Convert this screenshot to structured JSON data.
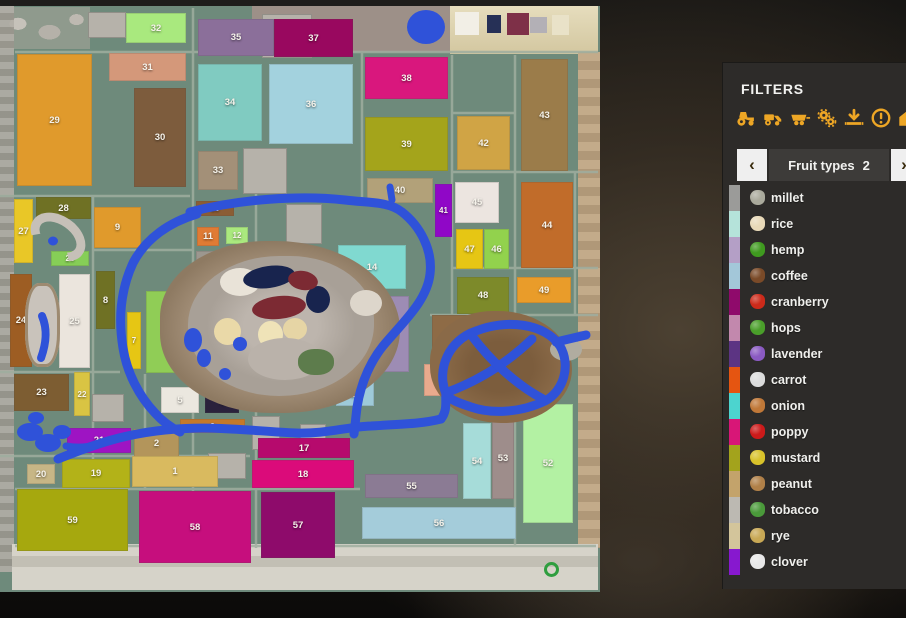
{
  "colors": {
    "accent": "#eda625",
    "water": "#2f52d9",
    "panel_bg": "#2d2b29",
    "marker_green": "#2f9e3f",
    "map_grass": "#6e8a7b"
  },
  "filters_panel": {
    "title": "FILTERS",
    "icons": [
      {
        "name": "tractor-icon"
      },
      {
        "name": "harvester-icon"
      },
      {
        "name": "trailer-icon"
      },
      {
        "name": "gears-icon"
      },
      {
        "name": "unload-arrow-icon"
      },
      {
        "name": "warning-icon"
      },
      {
        "name": "house-icon"
      }
    ],
    "selector": {
      "prev": "‹",
      "label": "Fruit types",
      "count": "2",
      "next": "›"
    },
    "fruits": [
      {
        "label": "millet",
        "bar_color": "#9b9b99",
        "icon_color": "#aaaa9c"
      },
      {
        "label": "rice",
        "bar_color": "#b5e3da",
        "icon_color": "#e8d9b8"
      },
      {
        "label": "hemp",
        "bar_color": "#b49fc6",
        "icon_color": "#3f9a1f"
      },
      {
        "label": "coffee",
        "bar_color": "#a3c7d9",
        "icon_color": "#7a4a28"
      },
      {
        "label": "cranberry",
        "bar_color": "#8f0a6b",
        "icon_color": "#cc2a1a"
      },
      {
        "label": "hops",
        "bar_color": "#c288ad",
        "icon_color": "#4a9e2a"
      },
      {
        "label": "lavender",
        "bar_color": "#5c3483",
        "icon_color": "#8a5ac2"
      },
      {
        "label": "carrot",
        "bar_color": "#e55511",
        "icon_color": "#dcdcdc"
      },
      {
        "label": "onion",
        "bar_color": "#4cd4cf",
        "icon_color": "#c07838"
      },
      {
        "label": "poppy",
        "bar_color": "#d81677",
        "icon_color": "#cc1a1a"
      },
      {
        "label": "mustard",
        "bar_color": "#a3a31c",
        "icon_color": "#d8c22a"
      },
      {
        "label": "peanut",
        "bar_color": "#c3a36b",
        "icon_color": "#b08048"
      },
      {
        "label": "tobacco",
        "bar_color": "#bcb9b2",
        "icon_color": "#4a9a3a"
      },
      {
        "label": "rye",
        "bar_color": "#d3c59b",
        "icon_color": "#c8a855"
      },
      {
        "label": "clover",
        "bar_color": "#8718cf",
        "icon_color": "#e8e8e8"
      }
    ]
  },
  "map": {
    "fields": [
      {
        "id": "29",
        "x": 17,
        "y": 54,
        "w": 75,
        "h": 132,
        "color": "#e09a2c"
      },
      {
        "id": "31",
        "x": 109,
        "y": 53,
        "w": 77,
        "h": 28,
        "color": "#d4987a"
      },
      {
        "id": "30",
        "x": 134,
        "y": 88,
        "w": 52,
        "h": 99,
        "color": "#7d5c3d"
      },
      {
        "id": "32",
        "x": 126,
        "y": 13,
        "w": 60,
        "h": 30,
        "color": "#a9e97e"
      },
      {
        "id": "35",
        "x": 198,
        "y": 19,
        "w": 76,
        "h": 37,
        "color": "#8b6f9a"
      },
      {
        "id": "37",
        "x": 274,
        "y": 19,
        "w": 79,
        "h": 38,
        "color": "#99085f"
      },
      {
        "id": "34",
        "x": 198,
        "y": 64,
        "w": 64,
        "h": 77,
        "color": "#80cbc1"
      },
      {
        "id": "36",
        "x": 269,
        "y": 64,
        "w": 84,
        "h": 80,
        "color": "#a3d2de"
      },
      {
        "id": "33",
        "x": 198,
        "y": 151,
        "w": 40,
        "h": 39,
        "color": "#a39078"
      },
      {
        "id": "38",
        "x": 365,
        "y": 57,
        "w": 83,
        "h": 42,
        "color": "#d9177d"
      },
      {
        "id": "39",
        "x": 365,
        "y": 117,
        "w": 83,
        "h": 54,
        "color": "#a4a41b"
      },
      {
        "id": "42",
        "x": 457,
        "y": 116,
        "w": 53,
        "h": 54,
        "color": "#d0a445"
      },
      {
        "id": "43",
        "x": 521,
        "y": 59,
        "w": 47,
        "h": 112,
        "color": "#9b7c4a"
      },
      {
        "id": "40",
        "x": 367,
        "y": 178,
        "w": 66,
        "h": 25,
        "color": "#b2a179"
      },
      {
        "id": "41",
        "x": 435,
        "y": 184,
        "w": 17,
        "h": 53,
        "color": "#9007c7"
      },
      {
        "id": "45",
        "x": 455,
        "y": 182,
        "w": 44,
        "h": 41,
        "color": "#ece5e0"
      },
      {
        "id": "44",
        "x": 521,
        "y": 182,
        "w": 52,
        "h": 86,
        "color": "#c16c2a"
      },
      {
        "id": "47",
        "x": 456,
        "y": 229,
        "w": 27,
        "h": 40,
        "color": "#e6c614"
      },
      {
        "id": "46",
        "x": 484,
        "y": 229,
        "w": 25,
        "h": 40,
        "color": "#92d24d"
      },
      {
        "id": "48",
        "x": 457,
        "y": 277,
        "w": 52,
        "h": 37,
        "color": "#7d8a2a"
      },
      {
        "id": "49",
        "x": 517,
        "y": 277,
        "w": 54,
        "h": 26,
        "color": "#e99c2a"
      },
      {
        "id": "27",
        "x": 14,
        "y": 199,
        "w": 19,
        "h": 64,
        "color": "#e9c727"
      },
      {
        "id": "28",
        "x": 36,
        "y": 197,
        "w": 55,
        "h": 22,
        "color": "#6f7124"
      },
      {
        "id": "9",
        "x": 94,
        "y": 207,
        "w": 47,
        "h": 41,
        "color": "#e09a2c"
      },
      {
        "id": "26",
        "x": 51,
        "y": 251,
        "w": 38,
        "h": 15,
        "color": "#86ce57"
      },
      {
        "id": "10",
        "x": 196,
        "y": 201,
        "w": 38,
        "h": 15,
        "color": "#8b5d34"
      },
      {
        "id": "11",
        "x": 197,
        "y": 227,
        "w": 22,
        "h": 19,
        "color": "#e07b34"
      },
      {
        "id": "12",
        "x": 226,
        "y": 227,
        "w": 22,
        "h": 17,
        "color": "#aae97e"
      },
      {
        "id": "13",
        "x": 196,
        "y": 251,
        "w": 53,
        "h": 13,
        "color": "#9c978f"
      },
      {
        "id": "24",
        "x": 10,
        "y": 274,
        "w": 22,
        "h": 93,
        "color": "#9d5d23"
      },
      {
        "id": "25",
        "x": 59,
        "y": 274,
        "w": 31,
        "h": 94,
        "color": "#ebe5dd"
      },
      {
        "id": "8",
        "x": 96,
        "y": 271,
        "w": 19,
        "h": 58,
        "color": "#6f7124"
      },
      {
        "id": "7",
        "x": 127,
        "y": 312,
        "w": 14,
        "h": 57,
        "color": "#e6c614"
      },
      {
        "id": "6",
        "x": 146,
        "y": 291,
        "w": 38,
        "h": 82,
        "color": "#90cd56"
      },
      {
        "id": "14",
        "x": 338,
        "y": 245,
        "w": 68,
        "h": 44,
        "color": "#80d9d0"
      },
      {
        "id": "15",
        "x": 351,
        "y": 296,
        "w": 58,
        "h": 76,
        "color": "#9d8cb4"
      },
      {
        "id": "23",
        "x": 14,
        "y": 374,
        "w": 55,
        "h": 37,
        "color": "#7d5d32"
      },
      {
        "id": "22",
        "x": 74,
        "y": 372,
        "w": 16,
        "h": 44,
        "color": "#d9c443"
      },
      {
        "id": "5",
        "x": 161,
        "y": 387,
        "w": 38,
        "h": 26,
        "color": "#ebe7df"
      },
      {
        "id": "4",
        "x": 205,
        "y": 392,
        "w": 34,
        "h": 21,
        "color": "#2a213c"
      },
      {
        "id": "3",
        "x": 180,
        "y": 419,
        "w": 65,
        "h": 14,
        "color": "#c5792b"
      },
      {
        "id": "2",
        "x": 134,
        "y": 429,
        "w": 45,
        "h": 29,
        "color": "#b3955b"
      },
      {
        "id": "21",
        "x": 67,
        "y": 428,
        "w": 64,
        "h": 25,
        "color": "#9e14c3"
      },
      {
        "id": "20",
        "x": 27,
        "y": 464,
        "w": 28,
        "h": 20,
        "color": "#c7b686"
      },
      {
        "id": "19",
        "x": 62,
        "y": 459,
        "w": 68,
        "h": 29,
        "color": "#b3b218"
      },
      {
        "id": "1",
        "x": 132,
        "y": 456,
        "w": 86,
        "h": 31,
        "color": "#d9ba5f"
      },
      {
        "id": "16",
        "x": 336,
        "y": 382,
        "w": 38,
        "h": 24,
        "color": "#9ecad9"
      },
      {
        "id": "17",
        "x": 258,
        "y": 438,
        "w": 92,
        "h": 20,
        "color": "#b60a6d"
      },
      {
        "id": "18",
        "x": 252,
        "y": 460,
        "w": 102,
        "h": 28,
        "color": "#db0b7a"
      },
      {
        "id": "50",
        "x": 432,
        "y": 315,
        "w": 64,
        "h": 34,
        "color": "#8e6b46"
      },
      {
        "id": "51",
        "x": 424,
        "y": 364,
        "w": 39,
        "h": 32,
        "color": "#e9aa8d"
      },
      {
        "id": "59",
        "x": 17,
        "y": 489,
        "w": 111,
        "h": 62,
        "color": "#a6a80e"
      },
      {
        "id": "58",
        "x": 139,
        "y": 491,
        "w": 112,
        "h": 72,
        "color": "#c60e7d"
      },
      {
        "id": "57",
        "x": 261,
        "y": 492,
        "w": 74,
        "h": 66,
        "color": "#8e0b6b"
      },
      {
        "id": "55",
        "x": 365,
        "y": 474,
        "w": 93,
        "h": 24,
        "color": "#8b7b94"
      },
      {
        "id": "54",
        "x": 463,
        "y": 423,
        "w": 28,
        "h": 76,
        "color": "#a6dcd9"
      },
      {
        "id": "53",
        "x": 492,
        "y": 418,
        "w": 22,
        "h": 81,
        "color": "#9e8d8b"
      },
      {
        "id": "52",
        "x": 523,
        "y": 404,
        "w": 50,
        "h": 119,
        "color": "#b3f1a3"
      },
      {
        "id": "56",
        "x": 362,
        "y": 507,
        "w": 154,
        "h": 32,
        "color": "#a4ccda"
      }
    ],
    "beach_huts": [
      {
        "x": 455,
        "y": 12,
        "w": 24,
        "h": 23,
        "color": "#f2efe6"
      },
      {
        "x": 487,
        "y": 15,
        "w": 14,
        "h": 18,
        "color": "#263056"
      },
      {
        "x": 507,
        "y": 13,
        "w": 22,
        "h": 22,
        "color": "#7e3048"
      },
      {
        "x": 530,
        "y": 17,
        "w": 17,
        "h": 16,
        "color": "#b3b0b6"
      },
      {
        "x": 552,
        "y": 15,
        "w": 17,
        "h": 20,
        "color": "#e9e2c8"
      }
    ]
  }
}
